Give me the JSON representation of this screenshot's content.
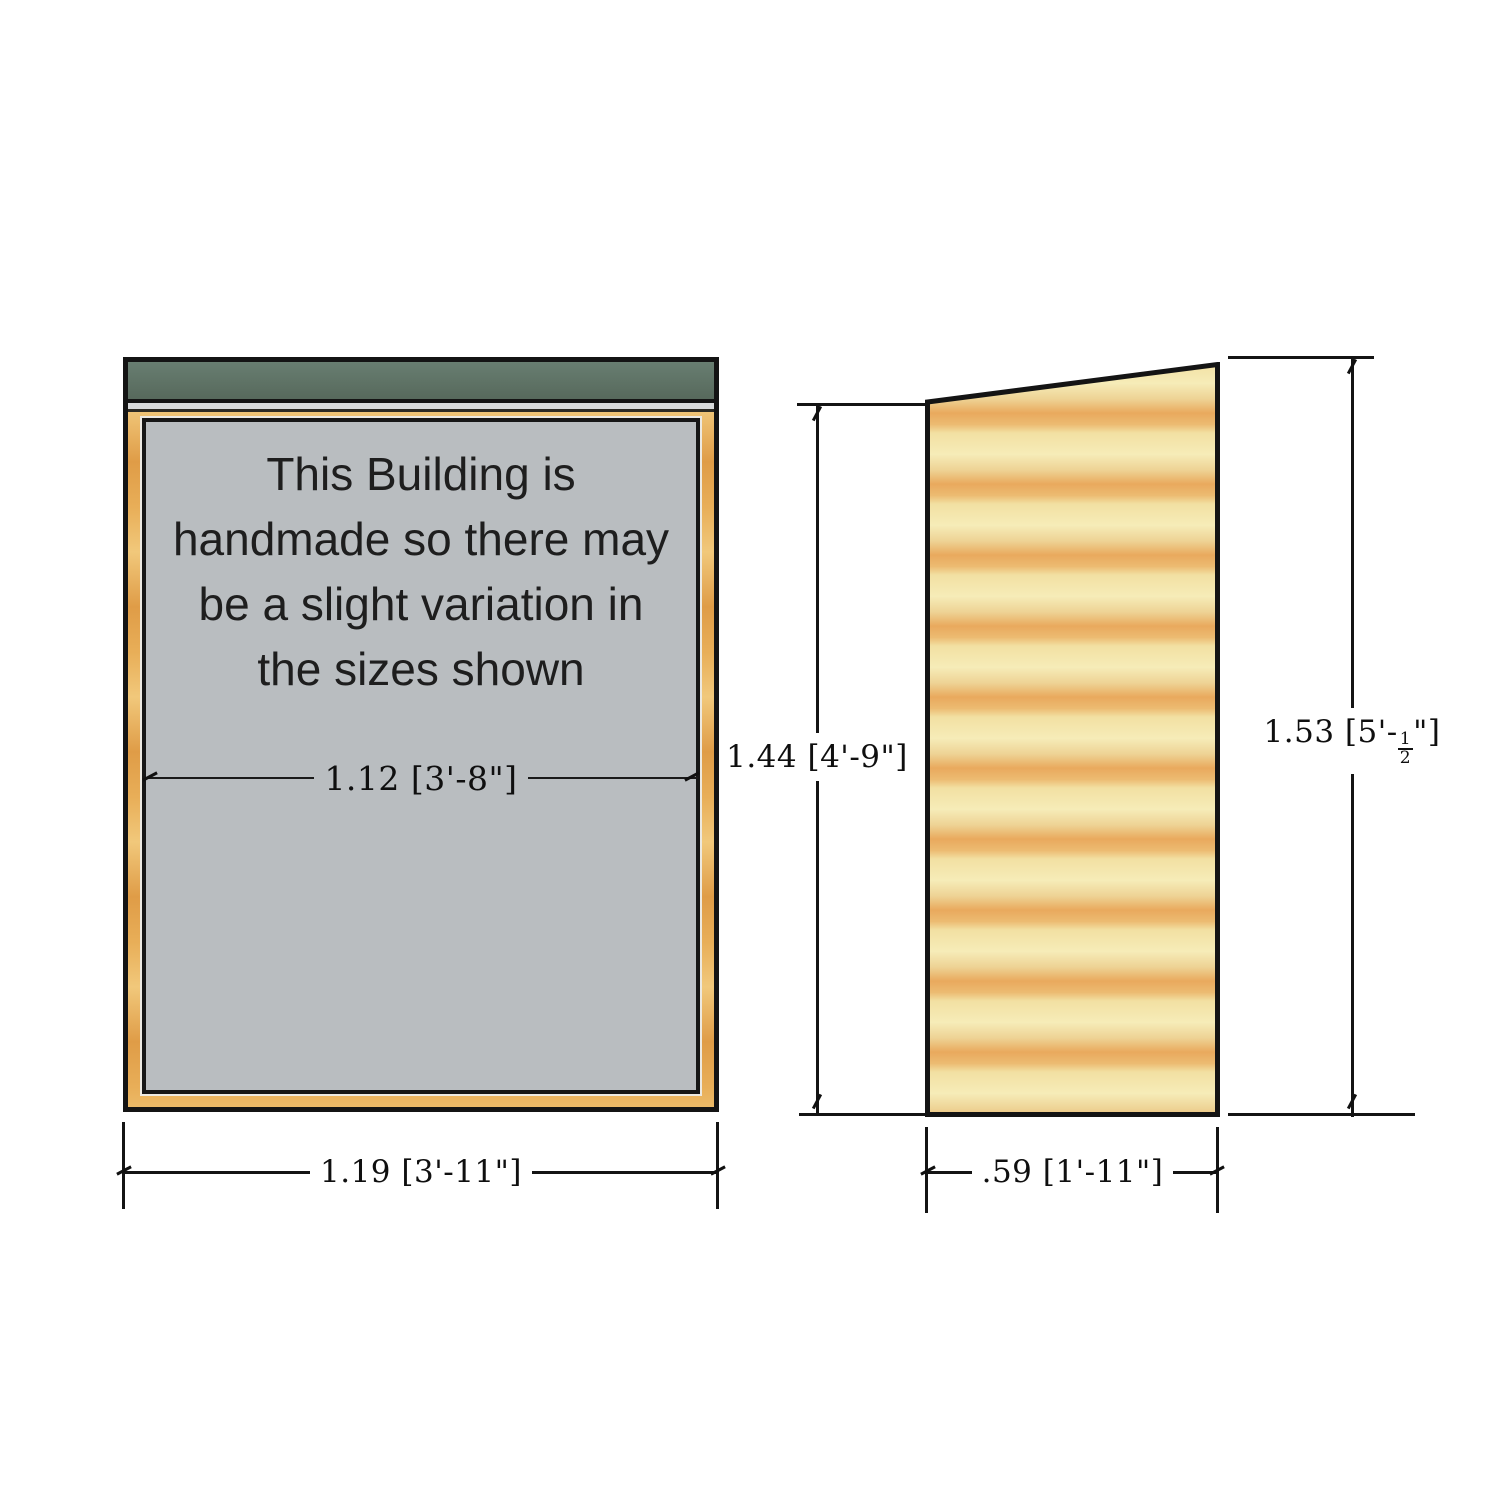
{
  "notice": {
    "lines": [
      "This Building is",
      "handmade so there may",
      "be a slight variation in",
      "the sizes shown"
    ]
  },
  "front_view": {
    "inner_width_label": "1.12 [3'-8\"]",
    "outer_width_label": "1.19 [3'-11\"]"
  },
  "side_view": {
    "rear_height_label": "1.44 [4'-9\"]",
    "front_height_prefix": "1.53 [5'-",
    "front_height_frac_num": "1",
    "front_height_frac_den": "2",
    "front_height_suffix": "\"]",
    "depth_label": ".59 [1'-11\"]"
  },
  "colors": {
    "roof_green": "#5e7366",
    "panel_gray": "#b9bdc0",
    "frame_wood": "#e8ae58",
    "side_wood_light": "#f2e0a2",
    "side_wood_band": "#e9a95d",
    "line_black": "#141414"
  }
}
